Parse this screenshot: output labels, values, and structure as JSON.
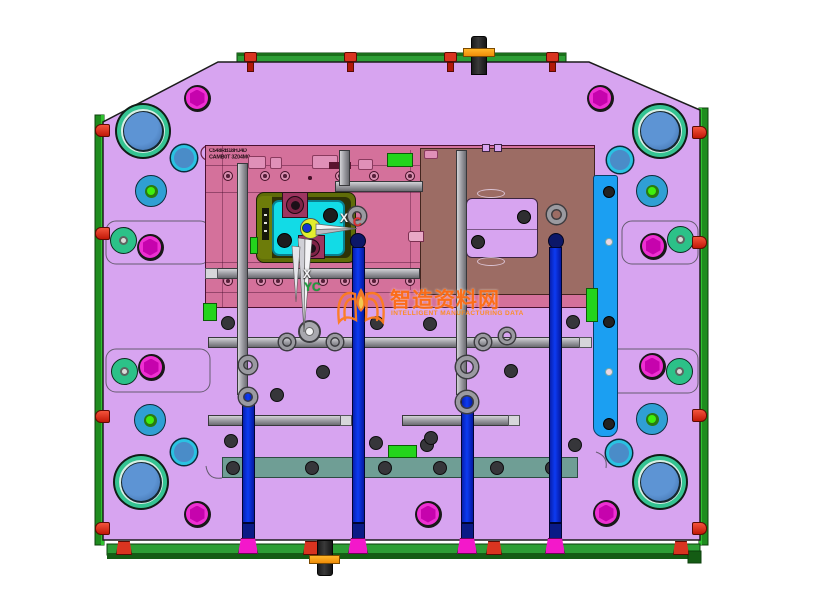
{
  "meta": {
    "description": "CAD top view of plastic injection mold base, moving half",
    "canvas_w": 832,
    "canvas_h": 609
  },
  "watermark": {
    "cn": "智造资料网",
    "en": "INTELLIGENT MANUFACTURING DATA",
    "logo": "open-book-flame-icon"
  },
  "labels": {
    "axis_x_white": "X",
    "axis_c_red": "C",
    "axis_down_x": "X",
    "axis_yc_green": "YC"
  },
  "stamp": {
    "line1": "C548RB18HJ4D",
    "line2": "CAMB0T 3Z04M0"
  },
  "colors": {
    "plate": "#d7a4f0",
    "pink": "#d4719b",
    "brown": "#9c6c64",
    "azure": "#1b9ff2",
    "cyan": "#12dbe6",
    "tealbar": "#6f9e95",
    "railDark": "#1f8c1f",
    "railBright": "#2fc12f",
    "barGreen": "#2d9e35",
    "barDark": "#145c14",
    "red": "#d93420",
    "orange": "#f09010",
    "magenta": "#ee2fd2",
    "hexDark": "#c603ad",
    "bluePillar": "#0d3bf2",
    "footMagenta": "#f318ca",
    "bushTeal": "#35c392",
    "bushBlue": "#4e86c6",
    "discBlue": "#2f9fd4",
    "discGreen": "#3ef00d",
    "tealCircle": "#2cc188",
    "cyanRing": "#2ac2e2",
    "rod": "#97979d",
    "hole": "#36363a",
    "wmOrange": "#ff6d15",
    "greenBlock": "#23d41c"
  },
  "features": {
    "bushings": [
      [
        143,
        131
      ],
      [
        660,
        131
      ],
      [
        141,
        482
      ],
      [
        660,
        482
      ]
    ],
    "magenta_bolts": [
      [
        197,
        98
      ],
      [
        600,
        98
      ],
      [
        150,
        247
      ],
      [
        653,
        246
      ],
      [
        151,
        367
      ],
      [
        652,
        366
      ],
      [
        197,
        514
      ],
      [
        428,
        514
      ],
      [
        606,
        513
      ]
    ],
    "teal_circles": [
      [
        123,
        240
      ],
      [
        680,
        239
      ],
      [
        124,
        371
      ],
      [
        679,
        371
      ]
    ],
    "blue_discs": [
      [
        151,
        191
      ],
      [
        652,
        191
      ],
      [
        150,
        420
      ],
      [
        652,
        419
      ]
    ],
    "cyan_circles": [
      [
        184,
        158
      ],
      [
        620,
        160
      ],
      [
        184,
        452
      ],
      [
        619,
        453
      ]
    ],
    "dark_holes": [
      [
        228,
        323
      ],
      [
        377,
        323
      ],
      [
        430,
        324
      ],
      [
        323,
        372
      ],
      [
        277,
        395
      ],
      [
        231,
        441
      ],
      [
        376,
        443
      ],
      [
        427,
        445
      ],
      [
        511,
        371
      ],
      [
        573,
        322
      ],
      [
        575,
        445
      ],
      [
        431,
        438
      ]
    ],
    "insert_holes": [
      [
        330,
        215
      ],
      [
        284,
        240
      ]
    ],
    "block_holes": [
      [
        524,
        217
      ],
      [
        478,
        242
      ]
    ],
    "ring_bosses": [
      [
        287,
        342,
        8
      ],
      [
        335,
        342,
        8
      ],
      [
        483,
        342,
        8
      ],
      [
        507,
        336,
        8
      ],
      [
        357,
        216,
        9
      ],
      [
        556,
        214,
        9.5
      ],
      [
        248,
        365,
        9
      ],
      [
        248,
        397,
        9
      ],
      [
        467,
        367,
        11
      ],
      [
        467,
        402,
        11
      ]
    ],
    "big_ring": [
      309,
      331,
      11.5
    ],
    "navy_caps": [
      [
        358,
        241
      ],
      [
        556,
        241
      ]
    ],
    "rods_h": [
      [
        186,
        335,
        423
      ],
      [
        273,
        208,
        420
      ],
      [
        342,
        208,
        592
      ],
      [
        420,
        208,
        352
      ],
      [
        420,
        402,
        520
      ]
    ],
    "rods_v": [
      [
        344,
        150,
        186
      ],
      [
        242,
        163,
        395
      ],
      [
        461,
        150,
        395
      ]
    ],
    "rod_caps": [
      [
        205,
        268,
        13,
        11
      ],
      [
        579,
        337,
        13,
        11
      ],
      [
        340,
        415,
        12,
        11
      ],
      [
        508,
        415,
        12,
        11
      ]
    ],
    "pillars": [
      [
        248,
        392
      ],
      [
        358,
        247
      ],
      [
        467,
        392
      ],
      [
        555,
        247
      ]
    ],
    "green_rects": [
      [
        203,
        303,
        14,
        18
      ],
      [
        387,
        153,
        26,
        14
      ],
      [
        586,
        288,
        12,
        34
      ],
      [
        388,
        445,
        29,
        13
      ],
      [
        250,
        237,
        8,
        17
      ]
    ],
    "screw_rings": [
      {
        "y": 176,
        "xs": [
          228,
          265,
          285,
          340,
          374,
          410
        ]
      },
      {
        "y": 281,
        "xs": [
          228,
          261,
          278,
          323,
          345,
          374,
          410
        ]
      }
    ],
    "tiny_dots": [
      [
        310,
        178
      ],
      [
        303,
        283
      ]
    ],
    "pink_tabs": [
      [
        248,
        156,
        18,
        13
      ],
      [
        270,
        157,
        12,
        12
      ],
      [
        312,
        155,
        26,
        14
      ],
      [
        358,
        159,
        15,
        11
      ],
      [
        424,
        150,
        14,
        9
      ]
    ],
    "dark_slot": [
      329,
      162,
      22,
      7
    ],
    "top_tabs": [
      [
        482,
        144,
        8,
        8
      ],
      [
        494,
        144,
        8,
        8
      ]
    ],
    "red_plugs_left_y": [
      131,
      234,
      417,
      529
    ],
    "red_plugs_right_y": [
      133,
      243,
      416,
      529
    ],
    "red_screws_top_x": [
      250,
      350,
      450,
      552
    ],
    "red_feet_x": [
      124,
      311,
      494,
      681
    ],
    "teal_bar_holes_x": [
      233,
      312,
      385,
      440,
      497,
      552
    ],
    "azure_holes_dark_y": [
      191,
      321,
      423
    ],
    "azure_holes_light_y": [
      241,
      371
    ]
  }
}
